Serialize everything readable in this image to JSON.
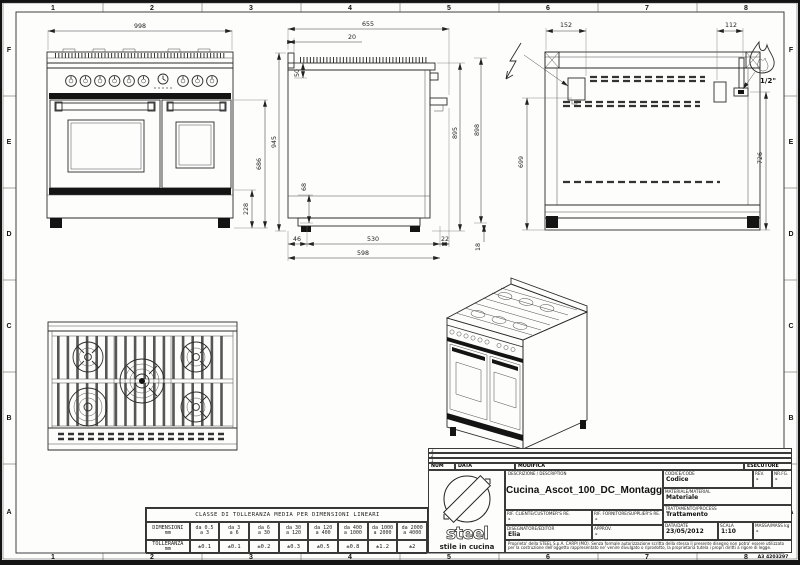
{
  "border": {
    "cols": [
      "1",
      "2",
      "3",
      "4",
      "5",
      "6",
      "7",
      "8"
    ],
    "rows": [
      "F",
      "E",
      "D",
      "C",
      "B",
      "A"
    ],
    "sheet_code": "A3 4203297"
  },
  "front_view": {
    "dim_width": "998",
    "dim_height_body": "686",
    "dim_height_base": "228"
  },
  "side_view": {
    "dim_depth_total": "655",
    "dim_backguard": "20",
    "dim_splash_height": "50",
    "dim_height_total": "945",
    "dim_height_front": "895",
    "dim_height_back": "898",
    "dim_plinth": "68",
    "dim_foot_back": "46",
    "dim_foot_span": "530",
    "dim_foot_front": "22",
    "dim_depth_base": "598",
    "dim_foot_height": "18"
  },
  "back_view": {
    "dim_elec_offset": "152",
    "dim_gas_offset": "112",
    "dim_elec_height": "699",
    "dim_gas_height": "726",
    "gas_size": "1/2\""
  },
  "tolerance_table": {
    "title": "CLASSE DI TOLLERANZA MEDIA PER DIMENSIONI LINEARI",
    "row1_label": "DIMENSIONI",
    "row1_unit": "mm",
    "row2_label": "TOLLERANZA",
    "row2_unit": "mm",
    "ranges_from": [
      "da 0.5",
      "da 3",
      "da 6",
      "da 30",
      "da 120",
      "da 400",
      "da 1000",
      "da 2000"
    ],
    "ranges_to": [
      "a 3",
      "a 6",
      "a 30",
      "a 120",
      "a 400",
      "a 1000",
      "a 2000",
      "a 4000"
    ],
    "tolerances": [
      "±0.1",
      "±0.1",
      "±0.2",
      "±0.3",
      "±0.5",
      "±0.8",
      "±1.2",
      "±2"
    ]
  },
  "title_block": {
    "rev_rows": [
      "3",
      "2",
      "1"
    ],
    "num_label": "NUM",
    "data_col_label": "DATA",
    "modifica_label": "MODIFICA",
    "esecutore_label": "ESECUTORE",
    "descr_label": "DESCRIZIONE / DESCRIPTION",
    "description": "Cucina_Ascot_100_DC_Montaggio",
    "codice_label": "CODICE/CODE",
    "codice": "Codice",
    "rev_label": "REV.",
    "rev": "-",
    "nrfg_label": "NR.FG.",
    "nrfg": "-",
    "materiale_label": "MATERIALE/MATERIAL",
    "materiale": "Materiale",
    "rif_cliente_label": "RIF. CLIENTE/CUSTOMER'S RE.",
    "rif_cliente": "-",
    "rif_fornitore_label": "RIF. FORNITORE/SUPPLIER'S RE.",
    "rif_fornitore": "-",
    "trattamento_label": "TRATTAMENTO/PROCESS",
    "trattamento": "Trattamento",
    "disegnatore_label": "DISEGNATORE/EDITOR",
    "disegnatore": "Elia",
    "approv_label": "APPROV.",
    "approv": "-",
    "data_label": "DATA/DATE",
    "data_value": "23/05/2012",
    "scala_label": "SCALA",
    "scala": "1:10",
    "massa_label": "MASSA/MASS kg",
    "massa": "-",
    "logo_text": "steel",
    "logo_sub": "stile in cucina",
    "disclaimer": "Proprieta' della STEEL S.p.A. CARPI (MO). Senza formale autorizzazione scritta della stessa il presente disegno non potra' essere utilizzato per la costruzione dell'oggetto rappresentato ne' venire divulgato o riprodotto, la proprietaria tutela i propri diritti a rigore di legge."
  }
}
